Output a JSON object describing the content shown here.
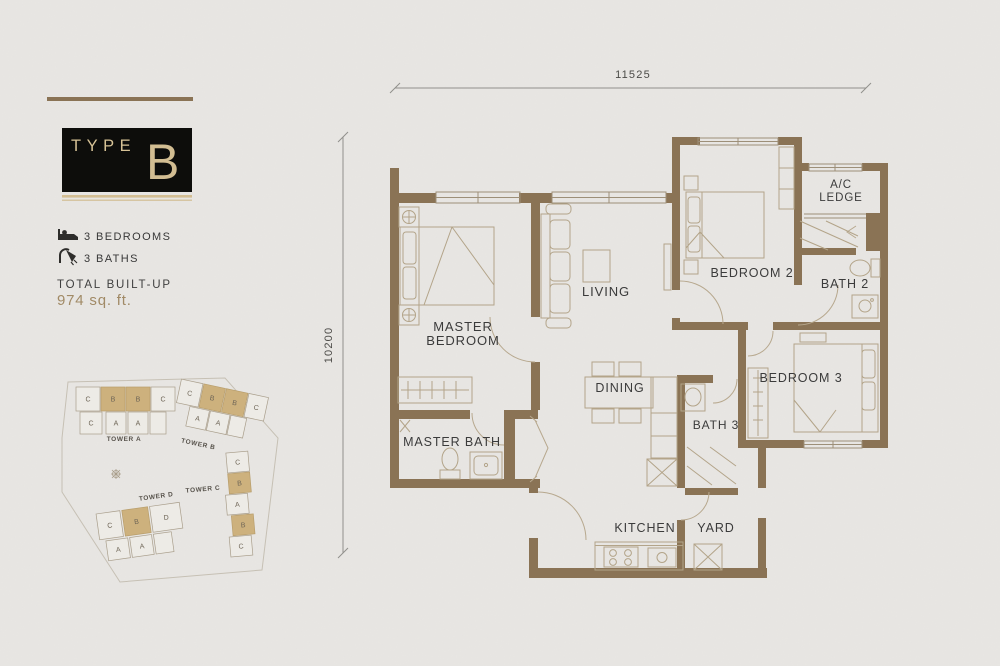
{
  "title_block": {
    "type_label": "TYPE",
    "type_letter": "B"
  },
  "facts": {
    "bedrooms": "3 BEDROOMS",
    "baths": "3 BATHS",
    "builtup_label": "TOTAL BUILT-UP",
    "builtup_value": "974 sq. ft."
  },
  "dimensions": {
    "width": "11525",
    "height": "10200"
  },
  "colors": {
    "background": "#e8e6e3",
    "wall": "#8a7355",
    "gold": "#d2bd92",
    "site_highlight": "#cdb17d",
    "furniture": "#b3a489",
    "label": "#3b3b3b",
    "builtup_value": "#a18a66",
    "card_black": "#0d0d0b"
  },
  "plan": {
    "labels": [
      {
        "t": "MASTER",
        "x": 463,
        "y": 331,
        "fs": 13
      },
      {
        "t": "BEDROOM",
        "x": 463,
        "y": 345,
        "fs": 13
      },
      {
        "t": "LIVING",
        "x": 606,
        "y": 296,
        "fs": 13
      },
      {
        "t": "DINING",
        "x": 620,
        "y": 392,
        "fs": 12.5
      },
      {
        "t": "BEDROOM 2",
        "x": 752,
        "y": 277,
        "fs": 12.5
      },
      {
        "t": "BATH 2",
        "x": 845,
        "y": 288,
        "fs": 12.5
      },
      {
        "t": "A/C",
        "x": 841,
        "y": 188,
        "fs": 11.5
      },
      {
        "t": "LEDGE",
        "x": 841,
        "y": 201,
        "fs": 11.5
      },
      {
        "t": "BEDROOM 3",
        "x": 801,
        "y": 382,
        "fs": 12.5
      },
      {
        "t": "BATH 3",
        "x": 716,
        "y": 429,
        "fs": 12
      },
      {
        "t": "MASTER BATH",
        "x": 452,
        "y": 446,
        "fs": 12.5
      },
      {
        "t": "KITCHEN",
        "x": 645,
        "y": 532,
        "fs": 12.5
      },
      {
        "t": "YARD",
        "x": 716,
        "y": 532,
        "fs": 12.5
      }
    ]
  },
  "site_plan": {
    "towers": [
      {
        "label": "TOWER A",
        "label_x": 124,
        "label_y": 441,
        "cells": [
          {
            "x": 76,
            "y": 387,
            "w": 24,
            "h": 24,
            "t": "C"
          },
          {
            "x": 101,
            "y": 387,
            "w": 24,
            "h": 24,
            "t": "B",
            "hl": true
          },
          {
            "x": 126,
            "y": 387,
            "w": 24,
            "h": 24,
            "t": "B",
            "hl": true
          },
          {
            "x": 151,
            "y": 387,
            "w": 24,
            "h": 24,
            "t": "C"
          },
          {
            "x": 80,
            "y": 412,
            "w": 22,
            "h": 22,
            "t": "C"
          },
          {
            "x": 106,
            "y": 412,
            "w": 20,
            "h": 22,
            "t": "A"
          },
          {
            "x": 128,
            "y": 412,
            "w": 20,
            "h": 22,
            "t": "A"
          },
          {
            "x": 150,
            "y": 412,
            "w": 16,
            "h": 22,
            "t": ""
          }
        ]
      },
      {
        "label": "TOWER B",
        "label_x": 208,
        "label_y": 450,
        "cells": [
          {
            "x": 178,
            "y": 388,
            "w": 22,
            "h": 24,
            "t": "C"
          },
          {
            "x": 201,
            "y": 388,
            "w": 22,
            "h": 24,
            "t": "B",
            "hl": true
          },
          {
            "x": 224,
            "y": 388,
            "w": 22,
            "h": 24,
            "t": "B",
            "hl": true
          },
          {
            "x": 247,
            "y": 388,
            "w": 20,
            "h": 24,
            "t": "C"
          },
          {
            "x": 192,
            "y": 413,
            "w": 20,
            "h": 20,
            "t": "A"
          },
          {
            "x": 213,
            "y": 413,
            "w": 20,
            "h": 20,
            "t": "A"
          },
          {
            "x": 234,
            "y": 413,
            "w": 16,
            "h": 20,
            "t": ""
          }
        ]
      },
      {
        "label": "TOWER C",
        "label_x": 204,
        "label_y": 488,
        "cells": [
          {
            "x": 230,
            "y": 452,
            "w": 22,
            "h": 20,
            "t": "C"
          },
          {
            "x": 230,
            "y": 473,
            "w": 22,
            "h": 20,
            "t": "B",
            "hl": true
          },
          {
            "x": 226,
            "y": 494,
            "w": 22,
            "h": 20,
            "t": "A"
          },
          {
            "x": 230,
            "y": 515,
            "w": 22,
            "h": 20,
            "t": "B",
            "hl": true
          },
          {
            "x": 226,
            "y": 536,
            "w": 22,
            "h": 20,
            "t": "C"
          }
        ]
      },
      {
        "label": "TOWER D",
        "label_x": 160,
        "label_y": 501,
        "cells": [
          {
            "x": 98,
            "y": 508,
            "w": 24,
            "h": 26,
            "t": "C"
          },
          {
            "x": 124,
            "y": 508,
            "w": 26,
            "h": 26,
            "t": "B",
            "hl": true
          },
          {
            "x": 152,
            "y": 508,
            "w": 30,
            "h": 26,
            "t": "D"
          },
          {
            "x": 104,
            "y": 536,
            "w": 22,
            "h": 20,
            "t": "A"
          },
          {
            "x": 128,
            "y": 536,
            "w": 22,
            "h": 20,
            "t": "A"
          },
          {
            "x": 152,
            "y": 536,
            "w": 18,
            "h": 20,
            "t": ""
          }
        ]
      }
    ]
  }
}
